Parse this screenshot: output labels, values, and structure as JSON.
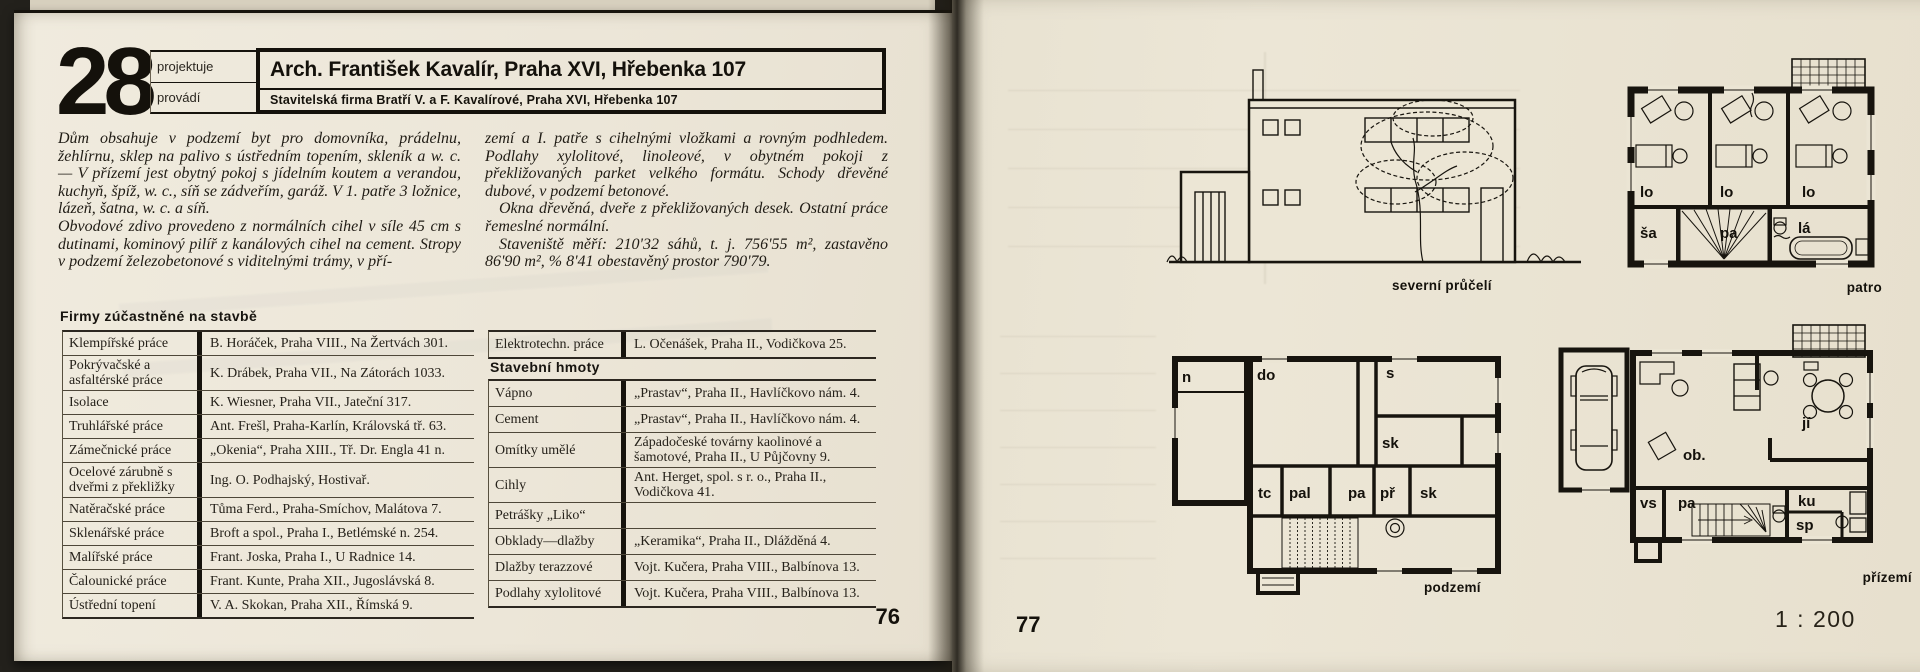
{
  "left_page": {
    "number": "28",
    "role_top": "projektuje",
    "role_bottom": "provádí",
    "title": "Arch. František Kavalír, Praha XVI, Hřebenka 107",
    "subtitle": "Stavitelská firma Bratří V. a F. Kavalírové, Praha XVI, Hřebenka 107",
    "paragraphs": {
      "c1p1": "Dům obsahuje v podzemí byt pro domovníka, prádelnu, žehlírnu, sklep na palivo s ústředním topením, skleník a w. c. — V přízemí jest obytný pokoj s jídelním koutem a verandou, kuchyň, špíž, w. c., síň se zádveřím, garáž. V 1. patře 3 ložnice, lázeň, šatna, w. c. a síň.",
      "c1p2": "Obvodové zdivo provedeno z normálních cihel v síle 45 cm s dutinami, kominový pilíř z kanálových cihel na cement. Stropy v podzemí železobetonové s viditelnými trámy, v pří-",
      "c2p1": "zemí a I. patře s cihelnými vložkami a rovným podhledem. Podlahy xylolitové, linoleové, v obytném pokoji z překližovaných parket velkého formátu. Schody dřevěné dubové, v podzemí betonové.",
      "c2p2": "Okna dřevěná, dveře z překližovaných desek. Ostatní práce řemeslné normální.",
      "c2p3": "Staveniště měří: 210'32 sáhů, t. j. 756'55 m², zastavěno 86'90 m², % 8'41 obestavěný prostor 790'79."
    },
    "firms_heading": "Firmy zúčastněné na stavbě",
    "firms": [
      {
        "label": "Klempířské práce",
        "value": "B. Horáček, Praha VIII., Na Žertvách 301."
      },
      {
        "label": "Pokrývačské a asfaltérské práce",
        "value": "K. Drábek, Praha VII., Na Zátorách 1033."
      },
      {
        "label": "Isolace",
        "value": "K. Wiesner, Praha VII., Jateční 317."
      },
      {
        "label": "Truhlářské práce",
        "value": "Ant. Frešl, Praha-Karlín, Královská tř. 63."
      },
      {
        "label": "Zámečnické práce",
        "value": "„Okenia“, Praha XIII., Tř. Dr. Engla 41 n."
      },
      {
        "label": "Ocelové zárubně s dveřmi z překližky",
        "value": "Ing. O. Podhajský, Hostivař."
      },
      {
        "label": "Natěračské práce",
        "value": "Tůma Ferd., Praha-Smíchov, Malátova 7."
      },
      {
        "label": "Sklenářské práce",
        "value": "Broft a spol., Praha I., Betlémské n. 254."
      },
      {
        "label": "Malířské práce",
        "value": "Frant. Joska, Praha I., U Radnice 14."
      },
      {
        "label": "Čalounické práce",
        "value": "Frant. Kunte, Praha XII., Jugoslávská 8."
      },
      {
        "label": "Ústřední topení",
        "value": "V. A. Skokan, Praha XII., Římská 9."
      }
    ],
    "electro": {
      "label": "Elektrotechn. práce",
      "value": "L. Očenášek, Praha II., Vodičkova 25."
    },
    "materials_heading": "Stavební hmoty",
    "materials": [
      {
        "label": "Vápno",
        "value": "„Prastav“, Praha II., Havlíčkovo nám. 4."
      },
      {
        "label": "Cement",
        "value": "„Prastav“, Praha II., Havlíčkovo nám. 4."
      },
      {
        "label": "Omítky umělé",
        "value": "Západočeské továrny kaolinové a šamotové, Praha II., U Půjčovny 9."
      },
      {
        "label": "Cihly",
        "value": "Ant. Herget, spol. s r. o., Praha II., Vodičkova 41."
      },
      {
        "label": "Petrášky „Liko“",
        "value": ""
      },
      {
        "label": "Obklady—dlažby",
        "value": "„Keramika“, Praha II., Dlážděná 4."
      },
      {
        "label": "Dlažby terazzové",
        "value": "Vojt. Kučera, Praha VIII., Balbínova 13."
      },
      {
        "label": "Podlahy xylolitové",
        "value": "Vojt. Kučera, Praha VIII., Balbínova 13."
      }
    ],
    "page_number": "76"
  },
  "right_page": {
    "elevation_caption": "severní průčelí",
    "caption_patro": "patro",
    "caption_podzemi": "podzemí",
    "caption_prizemi": "přízemí",
    "rooms_patro": [
      "lo",
      "lo",
      "lo",
      "ša",
      "pa",
      "lá"
    ],
    "rooms_podzemi": [
      "n",
      "do",
      "s",
      "sk",
      "tc",
      "pal",
      "pa",
      "př",
      "sk"
    ],
    "rooms_prizemi": [
      "ob.",
      "jí",
      "vs",
      "pa",
      "ku",
      "sp"
    ],
    "scale": "1 : 200",
    "page_number": "77"
  },
  "colors": {
    "paper_left": "#ece6d8",
    "paper_right": "#eae4d3",
    "ink": "#17140e"
  }
}
